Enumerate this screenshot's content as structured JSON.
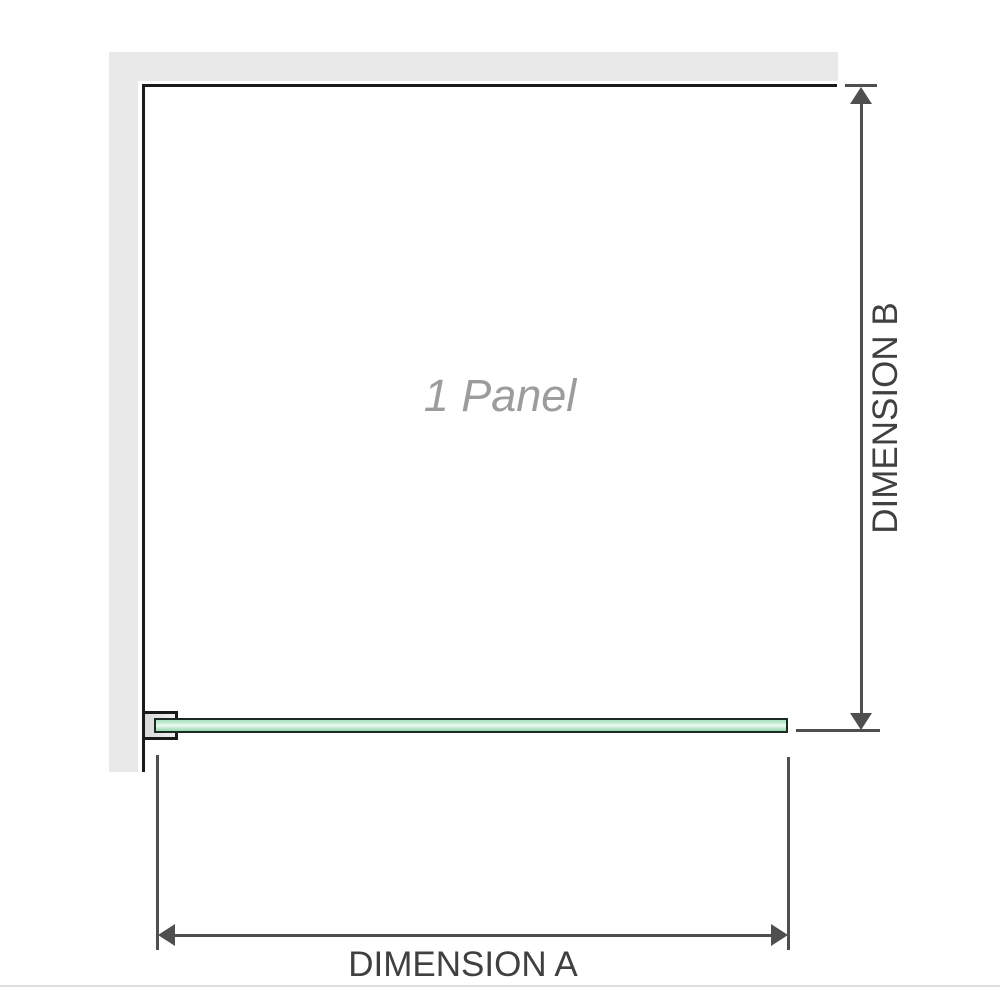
{
  "diagram": {
    "panel_label": "1 Panel",
    "dimension_a": {
      "label": "DIMENSION A",
      "orientation": "horizontal"
    },
    "dimension_b": {
      "label": "DIMENSION B",
      "orientation": "vertical"
    },
    "elements": {
      "wall": "L-shaped wall (top and left)",
      "glass_panel": "single frameless glass panel shown in plan view",
      "bracket": "wall-mount clamp at left end of glass panel"
    }
  },
  "colors": {
    "background": "#ffffff",
    "wall": "#e9e9e9",
    "outline": "#1a1a1a",
    "dimension": "#4f4f4f",
    "dimension_text": "#404040",
    "glass_border": "#1c2b22",
    "glass_green": "#a8dfbf",
    "glass_highlight": "#eefaf3",
    "bracket_fill": "#d9d9d9",
    "panel_label": "#9c9c9c",
    "image_border": "#dfdfdf"
  }
}
